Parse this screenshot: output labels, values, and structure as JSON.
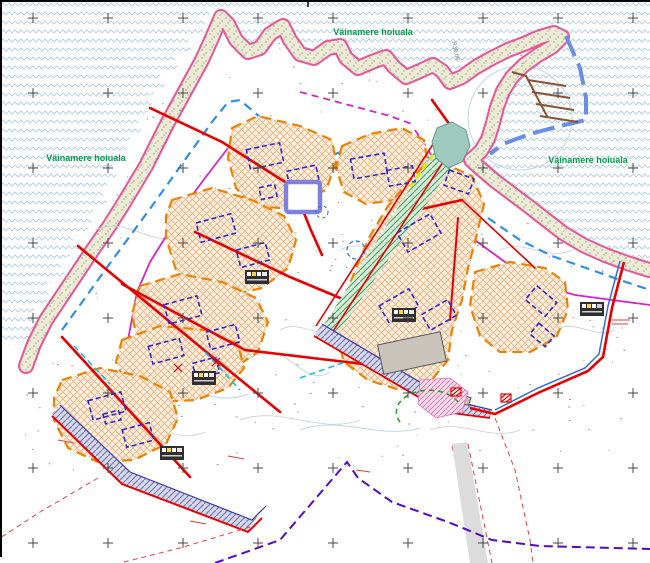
{
  "map": {
    "type": "detailed-plan-map",
    "labels": {
      "protected_area_left": "Väinamere hoiuala",
      "protected_area_top": "Väinamere hoiuala",
      "protected_area_right": "Väinamere hoiuala",
      "radius_annotation": "R30.00"
    },
    "colors": {
      "sea_wave": "#b9d3e6",
      "shoreline_pink": "#e8559a",
      "coast_vegetation_dash_green": "#1f7a1f",
      "beach_strip": "#ebebd6",
      "plot_boundary_orange": "#f08000",
      "plot_fill": "#fdf0e3",
      "building_envelope_blue": "#2a2ad0",
      "existing_building_gray": "#c9c5bd",
      "road_red": "#e80000",
      "plan_boundary_blue": "#3a6bd6",
      "exclusion_zone_dash_blue": "#2e8fe8",
      "magenta_line": "#d823c8",
      "ditch_cyan": "#16c0e8",
      "cadastral_dash_purple": "#5509c9",
      "protected_area_label_green": "#00a14b",
      "pier_brown": "#8a5230",
      "pond_teal": "#9ec9bd",
      "road_band_teal": "#d8ecdc",
      "road_band_bluegray": "#d6d9ec",
      "yellow_dash": "#e8e800"
    },
    "features": [
      "sea-with-wave-pattern",
      "shoreline",
      "beach-strip",
      "coastal-meadow",
      "building-plots-orange-dashed",
      "building-envelopes-blue-dashed",
      "existing-buildings",
      "access-roads-red",
      "hatched-road-bands",
      "plan-boundary-red-blue",
      "harbor-piers",
      "pond",
      "info-tables",
      "grid-crosses",
      "contour-lines",
      "ditches",
      "protected-area-labels"
    ]
  }
}
